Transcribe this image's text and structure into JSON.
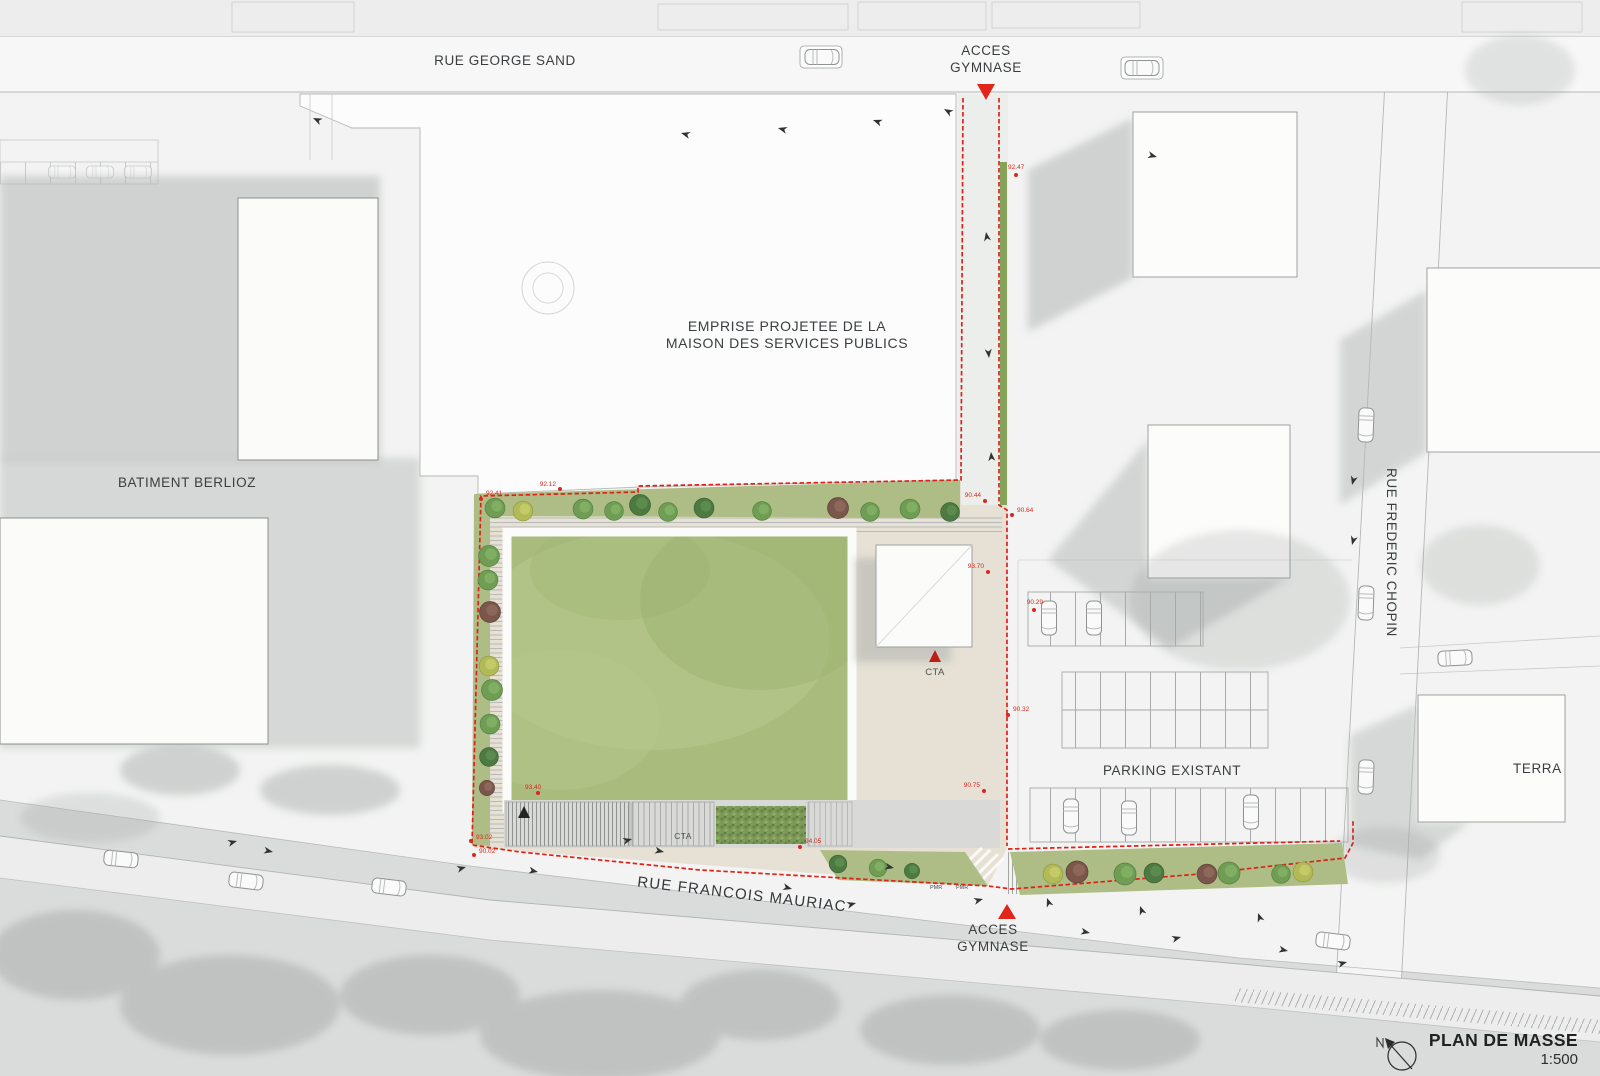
{
  "drawing": {
    "title": "PLAN DE MASSE",
    "scale": "1:500"
  },
  "streets": {
    "george_sand": "RUE GEORGE SAND",
    "francois_mauriac": "RUE FRANCOIS MAURIAC",
    "frederic_chopin": "RUE FREDERIC CHOPIN"
  },
  "areas": {
    "emprise": "EMPRISE PROJETEE DE LA\nMAISON DES SERVICES PUBLICS",
    "batiment_berlioz": "BATIMENT BERLIOZ",
    "parking_existant": "PARKING EXISTANT",
    "terrain_partial": "TERRA"
  },
  "access": {
    "top": "ACCES\nGYMNASE",
    "bottom": "ACCES\nGYMNASE"
  },
  "equipment": {
    "cta_building": "CTA",
    "cta_strip": "CTA",
    "pmr_a": "PMR",
    "pmr_b": "PMR"
  },
  "levels": [
    {
      "v": "92.47"
    },
    {
      "v": "90.44"
    },
    {
      "v": "92.12"
    },
    {
      "v": "92.41"
    },
    {
      "v": "93.70"
    },
    {
      "v": "90.64"
    },
    {
      "v": "90.29"
    },
    {
      "v": "90.32"
    },
    {
      "v": "90.75"
    },
    {
      "v": "93.40"
    },
    {
      "v": "94.05"
    },
    {
      "v": "93.02"
    },
    {
      "v": "90.02"
    }
  ],
  "colors": {
    "boundary_red": "#dd2318",
    "field_green": "#a9bc7d",
    "yard_beige": "#e6e1d4",
    "tree_green": "#6f9d54",
    "shadow_gray": "#b4b8b6"
  }
}
